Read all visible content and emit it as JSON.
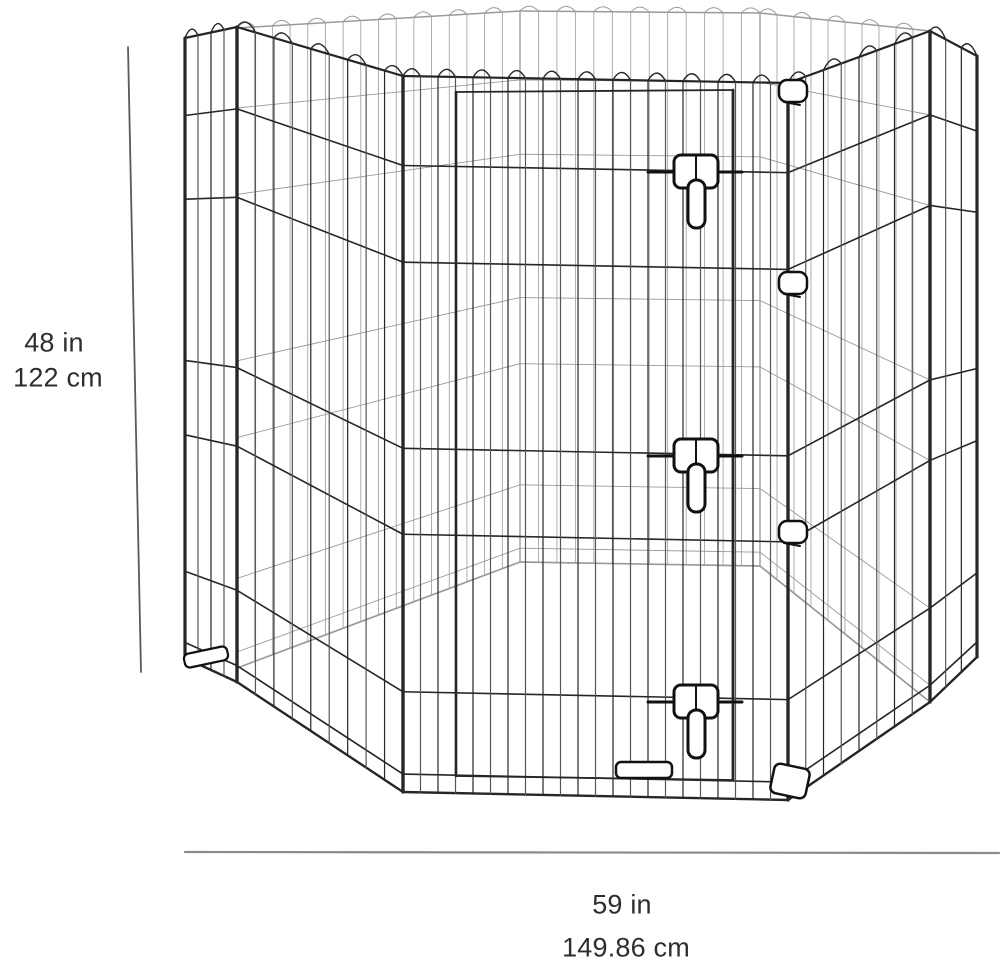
{
  "figure": {
    "alt": "Octagonal black wire pet exercise pen with latched door"
  },
  "dimensions": {
    "height_in": "48 in",
    "height_cm": "122 cm",
    "width_in": "59 in",
    "width_cm": "149.86 cm"
  },
  "colors": {
    "wire": "#262626",
    "wire_light": "#565656",
    "wire_back": "#9a9a9a",
    "hardware": "#111111",
    "dimension_line_vertical": "#5a5a5a",
    "dimension_line_horizontal": "#8a8a8a",
    "text": "#2e2e2e",
    "background": "#ffffff"
  }
}
